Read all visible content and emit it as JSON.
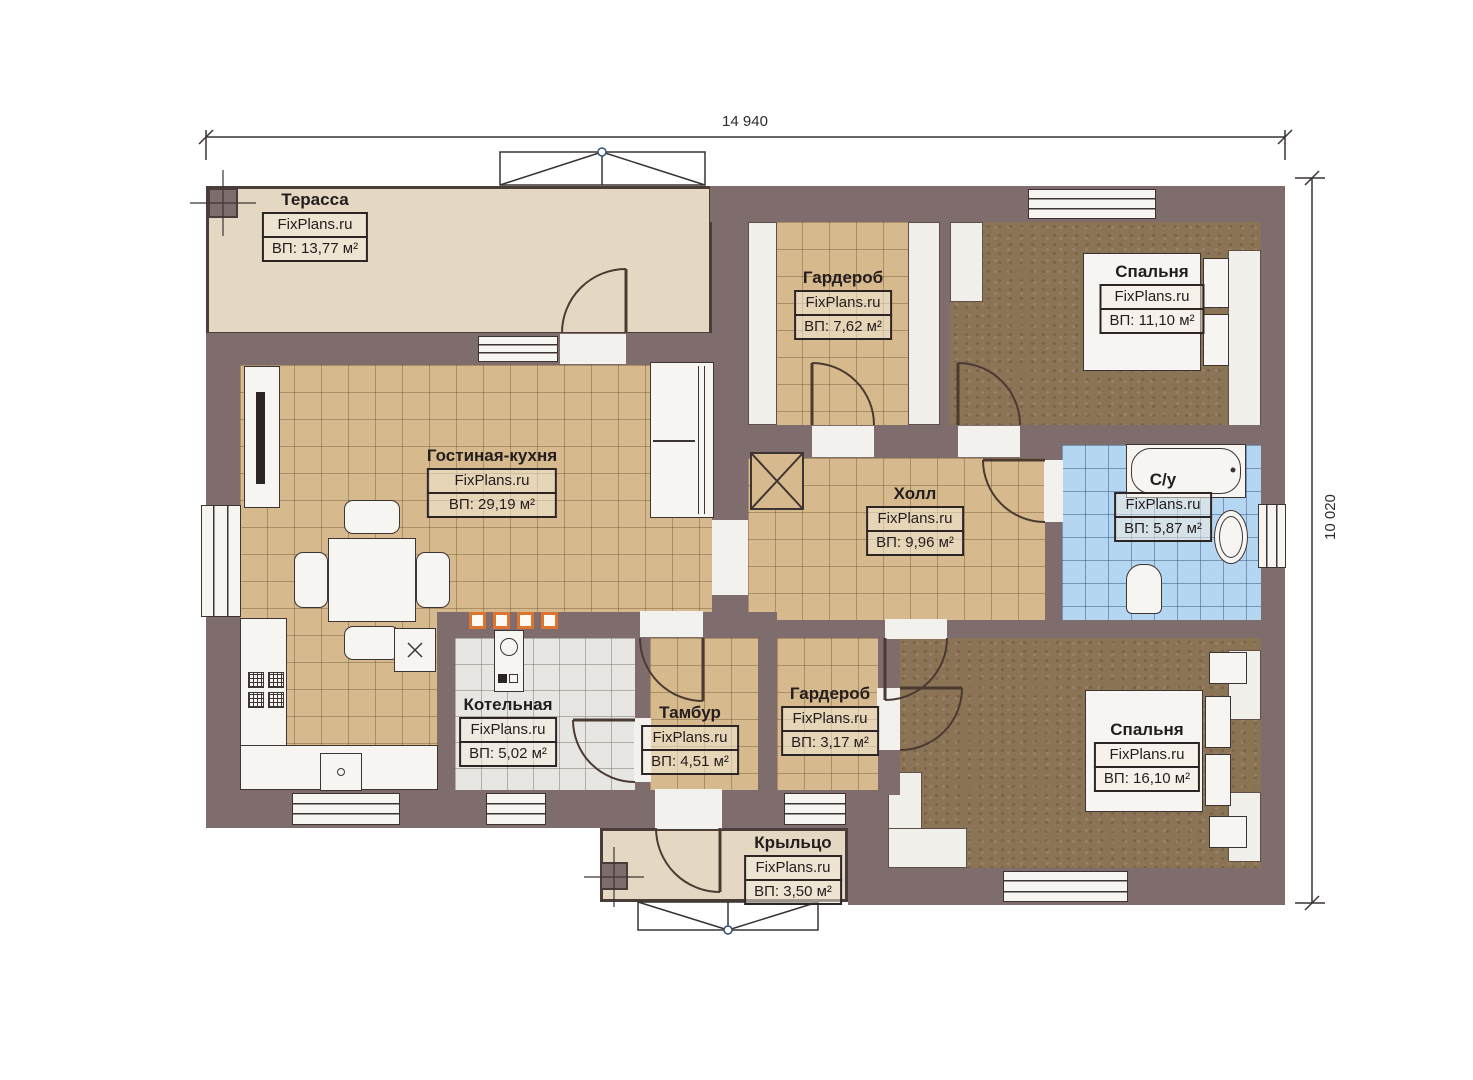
{
  "plan": {
    "brand": "FixPlans.ru",
    "dimensions": {
      "width_label": "14 940",
      "height_label": "10 020"
    },
    "rooms": [
      {
        "name": "Терасса",
        "area": "ВП: 13,77 м²"
      },
      {
        "name": "Гардероб",
        "area": "ВП: 7,62 м²"
      },
      {
        "name": "Спальня",
        "area": "ВП: 11,10 м²"
      },
      {
        "name": "Гостиная-кухня",
        "area": "ВП: 29,19 м²"
      },
      {
        "name": "Холл",
        "area": "ВП: 9,96 м²"
      },
      {
        "name": "С/у",
        "area": "ВП: 5,87 м²"
      },
      {
        "name": "Котельная",
        "area": "ВП: 5,02 м²"
      },
      {
        "name": "Тамбур",
        "area": "ВП: 4,51 м²"
      },
      {
        "name": "Гардероб",
        "area": "ВП: 3,17 м²"
      },
      {
        "name": "Спальня",
        "area": "ВП: 16,10 м²"
      },
      {
        "name": "Крыльцо",
        "area": "ВП: 3,50 м²"
      }
    ],
    "colors": {
      "wall": "#7f6c6c",
      "line": "#3f3434",
      "beige": "#e4d8c3",
      "tan": "#d6ba8d",
      "brown": "#8b7356",
      "blue": "#b5d6f1",
      "gray": "#e7e6e3",
      "fixture": "#f6f5f2",
      "accent": "#dd7430"
    }
  }
}
